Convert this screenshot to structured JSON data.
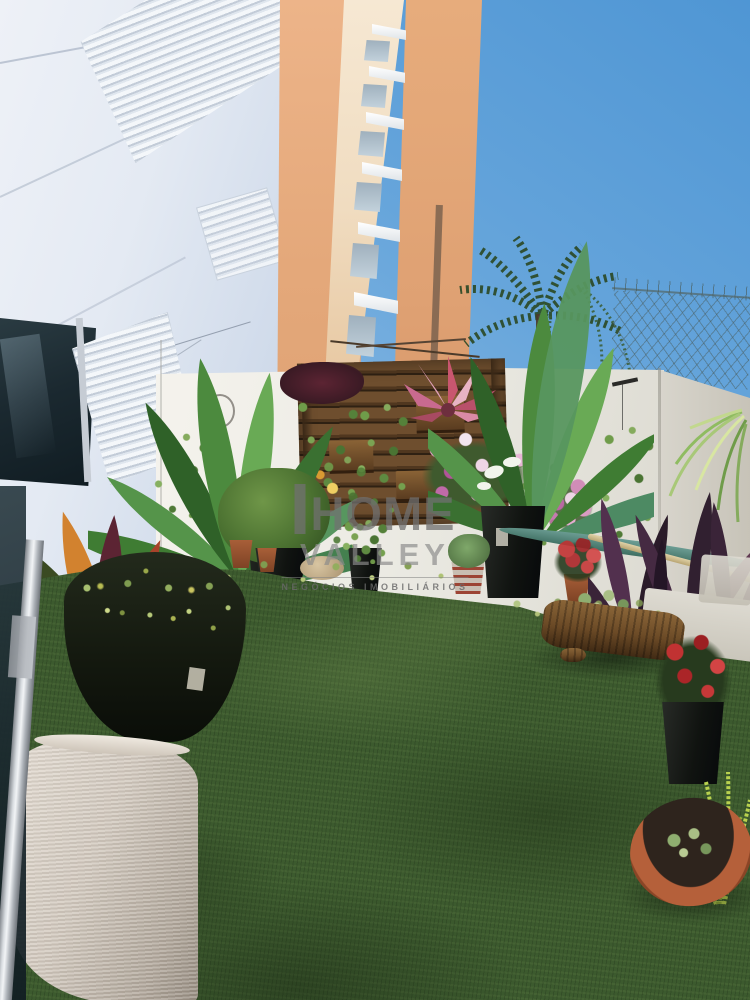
{
  "meta": {
    "type": "photograph",
    "subject": "Ground-floor apartment patio garden with artificial grass, a vertical pallet garden on a white boundary wall, tropical potted plants, an apartment tower rising above and blue sky"
  },
  "watermark": {
    "brand_top": "HOME",
    "brand_bottom": "VALLEY",
    "tagline": "NEGÓCIOS IMOBILIÁRIOS"
  },
  "scene": {
    "palette": {
      "sky_top": "#4f96d4",
      "sky_low": "#cfe0f0",
      "facade_white": "#e8edf4",
      "building_orange": "#e2a578",
      "building_cream": "#f2e0c6",
      "boundary_wall": "#eceae3",
      "grass_base": "#3c5a2e",
      "grass_highlight": "#7d9a55",
      "pallet_wood": "#5e4026",
      "watermark_gray": "#707070",
      "terracotta": "#b5603a",
      "pot_cream": "#d2c9be"
    },
    "elements": [
      "apartment-facade-with-louver-windows",
      "orange-corner-column",
      "stacked-window-ledges",
      "palm-tree-behind-wall",
      "chain-link-fence-on-wall",
      "white-boundary-wall",
      "pallet-vertical-garden",
      "bromeliad",
      "petunias",
      "trailing-vines",
      "bird-of-paradise-left",
      "bird-of-paradise-right",
      "croton-plant",
      "round-green-bush",
      "hanging-basket",
      "spider-plant",
      "purple-cordyline",
      "log-planter-with-succulents",
      "terracotta-succulent-bowl",
      "red-rose-pot",
      "chartreuse-fern",
      "large-cream-pot",
      "dark-bowl-planter",
      "metal-door-frame-pole",
      "artificial-grass-lawn"
    ]
  }
}
